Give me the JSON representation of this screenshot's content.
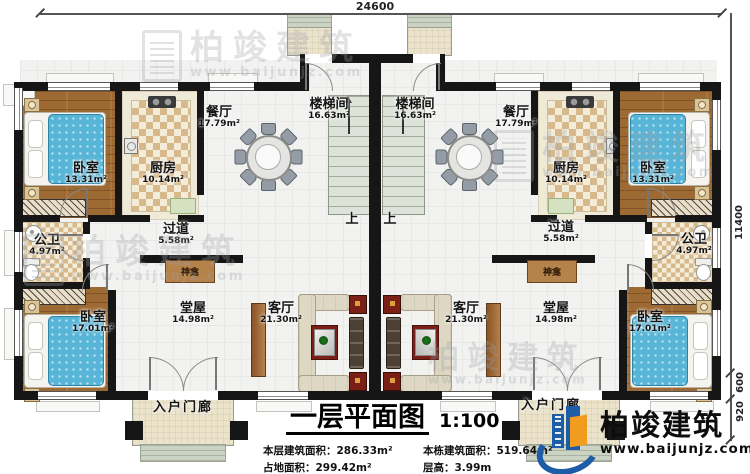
{
  "title_block": {
    "title": "一层平面图",
    "scale": "1:100",
    "stats": [
      {
        "label": "本层建筑面积：",
        "value": "286.33m²"
      },
      {
        "label": "本栋建筑面积：",
        "value": "519.64m²"
      },
      {
        "label": "占地面积：",
        "value": "299.42m²"
      },
      {
        "label": "层高：",
        "value": "3.99m"
      }
    ]
  },
  "brand": {
    "name": "柏竣建筑",
    "website": "www.baijunjz.com"
  },
  "watermark": {
    "name": "柏竣建筑",
    "website": "www.baijunjz.com"
  },
  "dimensions": {
    "top": "24600",
    "right": "11400",
    "seg_a": "600",
    "seg_b": "920"
  },
  "rooms": {
    "bedroom_front": {
      "label": "卧室",
      "area": "13.31m²"
    },
    "kitchen": {
      "label": "厨房",
      "area": "10.14m²"
    },
    "dining": {
      "label": "餐厅",
      "area": "17.79m²"
    },
    "stairwell": {
      "label": "楼梯间",
      "area": "16.63m²"
    },
    "corridor": {
      "label": "过道",
      "area": "5.58m²"
    },
    "bathroom": {
      "label": "公卫",
      "area": "4.97m²"
    },
    "hall": {
      "label": "堂屋",
      "area": "14.98m²"
    },
    "living": {
      "label": "客厅",
      "area": "21.30m²"
    },
    "bedroom_rear": {
      "label": "卧室",
      "area": "17.01m²"
    },
    "porch": {
      "label": "入户门廊"
    },
    "shrine": {
      "label": "神龛"
    },
    "stairs_up": {
      "label": "上"
    }
  },
  "colors": {
    "wall": "#161616",
    "brand_blue": "#1d5ca6",
    "brand_orange": "#f29c1f",
    "bed": "#57b5d7",
    "tv_red": "#7b1f16"
  }
}
